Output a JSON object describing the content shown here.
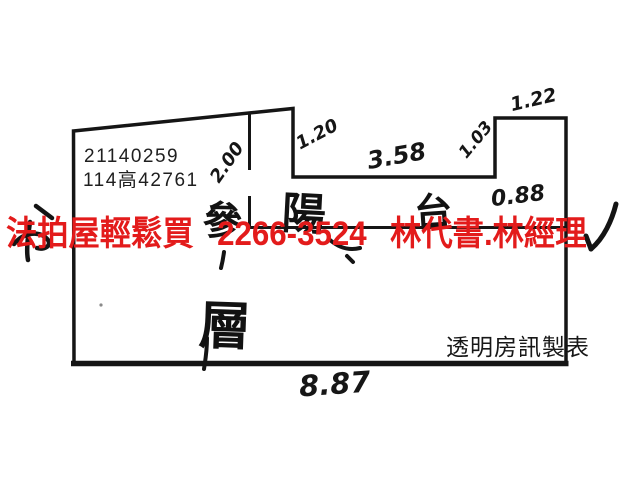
{
  "document": {
    "background_color": "#ffffff",
    "line_color": "#151515",
    "type": "scanned floor plan sketch"
  },
  "listing": {
    "case_number": "21140259",
    "reference_number": "114高42761"
  },
  "watermark": {
    "brand": "法拍屋輕鬆買",
    "phone": "2266-3524",
    "contact": "林代書.林經理",
    "color": "#e31b1b"
  },
  "credit": {
    "text": "透明房訊製表"
  },
  "floorplan": {
    "labels": {
      "balcony_char_1": "陽",
      "balcony_char_2": "台",
      "floor_char_1": "參",
      "floor_char_2": "層"
    },
    "measurements": {
      "left_wall": "2.00",
      "notch_left": "1.20",
      "top_middle": "3.58",
      "notch_right": "1.03",
      "top_right": "1.22",
      "balcony_depth": "0.88",
      "bottom_width": "8.87"
    }
  }
}
